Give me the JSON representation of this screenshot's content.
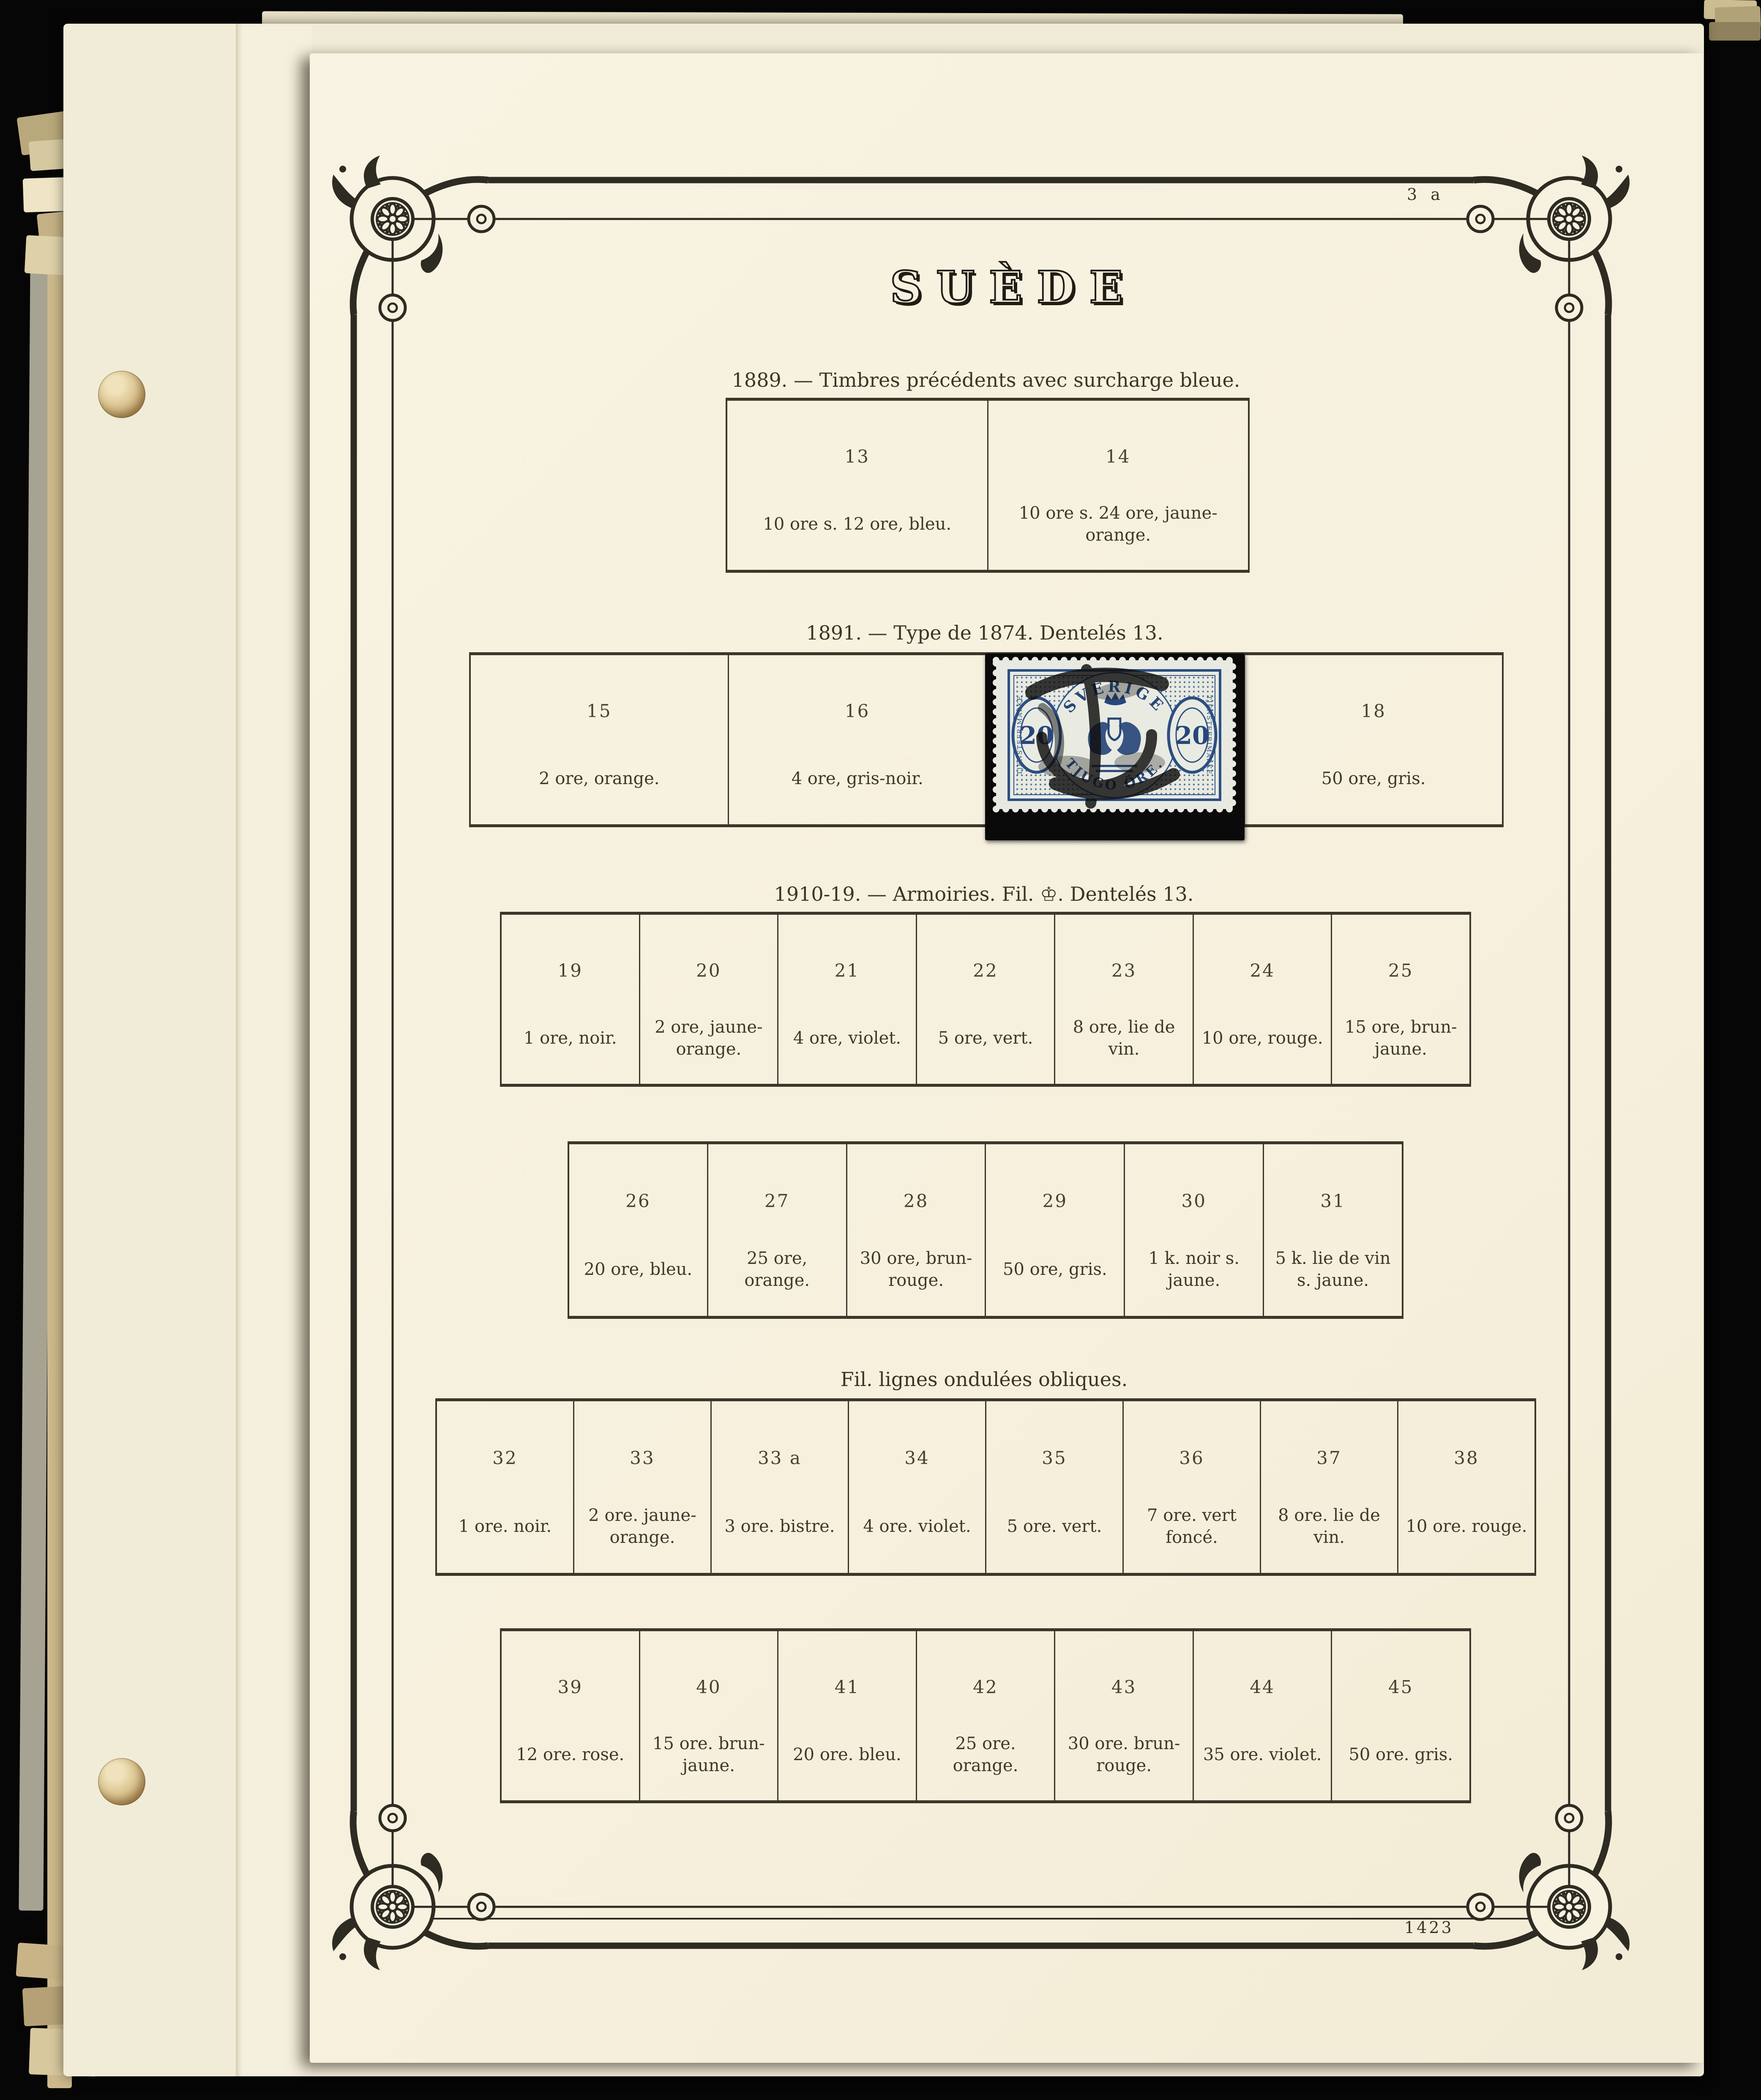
{
  "page": {
    "title": "SUÈDE",
    "page_number": "3 a",
    "plate_number": "1423",
    "colors": {
      "backdrop": "#060606",
      "page_paper": "#f7f2e0",
      "under_paper": "#f1ecd8",
      "border_ink": "#2e2b22",
      "text_ink": "#3e392b"
    }
  },
  "sections": [
    {
      "header": "1889. — Timbres précédents avec surcharge bleue.",
      "cells": [
        {
          "number": "13",
          "caption": "10 ore s. 12 ore, bleu."
        },
        {
          "number": "14",
          "caption": "10 ore s. 24 ore, jaune-orange."
        }
      ]
    },
    {
      "header": "1891. — Type de 1874. Dentelés 13.",
      "cells": [
        {
          "number": "15",
          "caption": "2 ore, orange."
        },
        {
          "number": "16",
          "caption": "4 ore, gris-noir."
        },
        {
          "number": "",
          "caption": "",
          "has_stamp": true
        },
        {
          "number": "18",
          "caption": "50 ore, gris."
        }
      ]
    },
    {
      "header": "1910-19. — Armoiries. Fil. ♔. Dentelés 13.",
      "cells": [
        {
          "number": "19",
          "caption": "1 ore, noir."
        },
        {
          "number": "20",
          "caption": "2 ore, jaune-orange."
        },
        {
          "number": "21",
          "caption": "4 ore, violet."
        },
        {
          "number": "22",
          "caption": "5 ore, vert."
        },
        {
          "number": "23",
          "caption": "8 ore, lie de vin."
        },
        {
          "number": "24",
          "caption": "10 ore, rouge."
        },
        {
          "number": "25",
          "caption": "15 ore, brun-jaune."
        }
      ]
    },
    {
      "header": "",
      "cells": [
        {
          "number": "26",
          "caption": "20 ore, bleu."
        },
        {
          "number": "27",
          "caption": "25 ore, orange."
        },
        {
          "number": "28",
          "caption": "30 ore, brun-rouge."
        },
        {
          "number": "29",
          "caption": "50 ore, gris."
        },
        {
          "number": "30",
          "caption": "1 k. noir s. jaune."
        },
        {
          "number": "31",
          "caption": "5 k. lie de vin\ns. jaune."
        }
      ]
    },
    {
      "header": "Fil. lignes ondulées obliques.",
      "cells": [
        {
          "number": "32",
          "caption": "1 ore. noir."
        },
        {
          "number": "33",
          "caption": "2 ore. jaune-orange."
        },
        {
          "number": "33 a",
          "caption": "3 ore. bistre."
        },
        {
          "number": "34",
          "caption": "4 ore. violet."
        },
        {
          "number": "35",
          "caption": "5 ore. vert."
        },
        {
          "number": "36",
          "caption": "7 ore. vert foncé."
        },
        {
          "number": "37",
          "caption": "8 ore. lie de vin."
        },
        {
          "number": "38",
          "caption": "10 ore. rouge."
        }
      ]
    },
    {
      "header": "",
      "cells": [
        {
          "number": "39",
          "caption": "12 ore. rose."
        },
        {
          "number": "40",
          "caption": "15 ore. brun-jaune."
        },
        {
          "number": "41",
          "caption": "20 ore. bleu."
        },
        {
          "number": "42",
          "caption": "25 ore. orange."
        },
        {
          "number": "43",
          "caption": "30 ore. brun-rouge."
        },
        {
          "number": "44",
          "caption": "35 ore. violet."
        },
        {
          "number": "45",
          "caption": "50 ore. gris."
        }
      ]
    }
  ],
  "stamp": {
    "country": "SVERIGE",
    "denomination": "TJUGO ÖRE.",
    "numeral": "20",
    "frame_text": "TJENSTEFRIMARKE",
    "ink_color": "#2c4e82",
    "paper_color": "#e8eae1",
    "cancel_color": "#0e0e0e",
    "mount_color": "#0a0a0a"
  }
}
